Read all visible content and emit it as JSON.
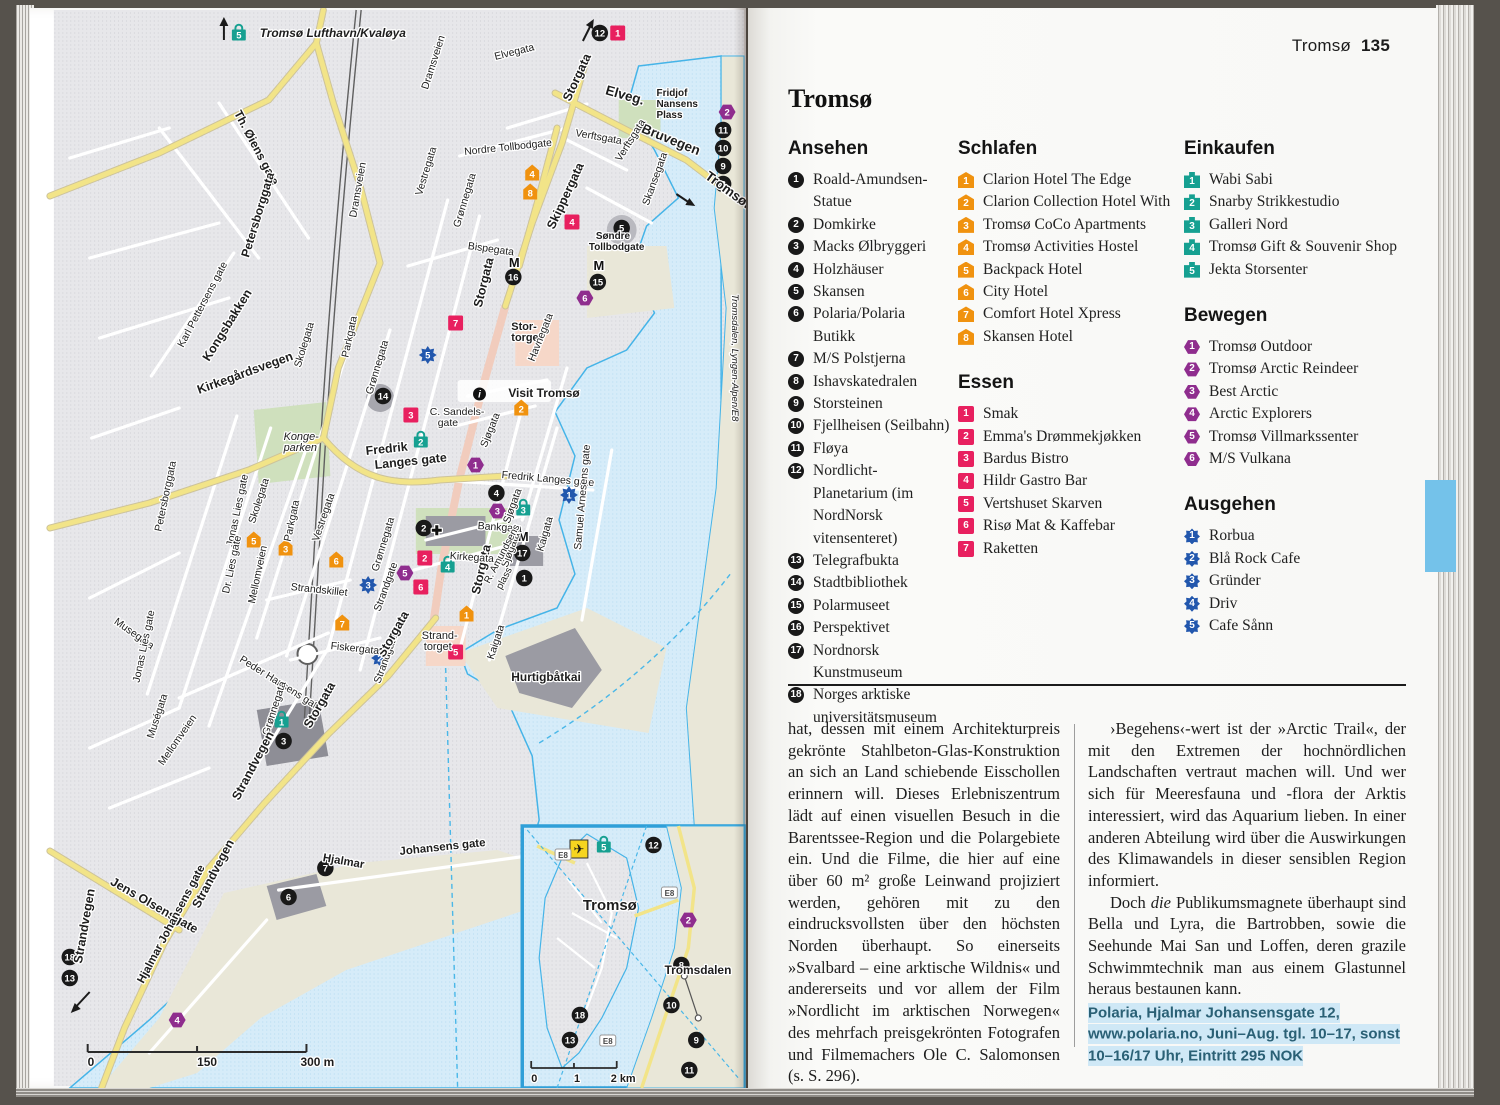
{
  "header": {
    "title": "Tromsø",
    "page_number": "135"
  },
  "title": "Tromsø",
  "section_order": [
    "ansehen",
    "schlafen",
    "essen",
    "einkaufen",
    "bewegen",
    "ausgehen"
  ],
  "sections": {
    "ansehen": {
      "header": "Ansehen",
      "type": "sight",
      "items": [
        "Roald-Amundsen-Statue",
        "Domkirke",
        "Macks Ølbryggeri",
        "Holzhäuser",
        "Skansen",
        "Polaria/Polaria Butikk",
        "M/S Polstjerna",
        "Ishavskatedralen",
        "Storsteinen",
        "Fjellheisen (Seilbahn)",
        "Fløya",
        "Nordlicht-Planetarium (im NordNorsk vitensenteret)",
        "Telegrafbukta",
        "Stadtbibliothek",
        "Polarmuseet",
        "Perspektivet",
        "Nordnorsk Kunstmuseum",
        "Norges arktiske universitätsmuseum"
      ]
    },
    "schlafen": {
      "header": "Schlafen",
      "type": "hotel",
      "items": [
        "Clarion Hotel The Edge",
        "Clarion Collection Hotel With",
        "Tromsø CoCo Apartments",
        "Tromsø Activities Hostel",
        "Backpack Hotel",
        "City Hotel",
        "Comfort Hotel Xpress",
        "Skansen Hotel"
      ]
    },
    "essen": {
      "header": "Essen",
      "type": "food",
      "items": [
        "Smak",
        "Emma's Drømmekjøkken",
        "Bardus Bistro",
        "Hildr Gastro Bar",
        "Vertshuset Skarven",
        "Risø Mat & Kaffebar",
        "Raketten"
      ]
    },
    "einkaufen": {
      "header": "Einkaufen",
      "type": "shop",
      "items": [
        "Wabi Sabi",
        "Snarby Strikkestudio",
        "Galleri Nord",
        "Tromsø Gift & Souvenir Shop",
        "Jekta Storsenter"
      ]
    },
    "bewegen": {
      "header": "Bewegen",
      "type": "move",
      "items": [
        "Tromsø Outdoor",
        "Tromsø Arctic Reindeer",
        "Best Arctic",
        "Arctic Explorers",
        "Tromsø Villmarkssenter",
        "M/S Vulkana"
      ]
    },
    "ausgehen": {
      "header": "Ausgehen",
      "type": "out",
      "items": [
        "Rorbua",
        "Blå Rock Cafe",
        "Gründer",
        "Driv",
        "Cafe Sånn"
      ]
    }
  },
  "body": {
    "col1": "hat, dessen mit einem Architekturpreis gekrönte Stahlbeton-Glas-Konstruktion an sich an Land schiebende Eisschollen erinnern will. Dieses Erlebniszentrum lädt auf einen visuellen Besuch in die Barentssee-Region und die Polargebiete ein. Und die Filme, die hier auf eine über 60 m² große Leinwand projiziert werden, gehören mit zu den eindrucksvollsten über den höchsten Norden überhaupt. So einerseits »Svalbard – eine arktische Wildnis« und andererseits und vor allem der Film »Nordlicht im arktischen Norwegen« des mehrfach preisgekrönten Fotografen und Filmemachers Ole C. Salomonsen (s. S. 296).",
    "col2a": "›Begehens‹-wert ist der »Arctic Trail«, der mit den Extremen der hochnördlichen Landschaften vertraut machen will. Und wer sich für Meeresfauna und -flora der Arktis interessiert, wird das Aquarium lieben. In einer anderen Abteilung wird über die Auswirkungen des Klimawandels in dieser sensiblen Region informiert.",
    "col2b_pre": "Doch ",
    "col2b_em": "die",
    "col2b_post": " Publikumsmagnete überhaupt sind Bella und Lyra, die Bartrobben, sowie die Seehunde Mai San und Loffen, deren grazile Schwimmtechnik man aus einem Glastunnel heraus bestaunen kann.",
    "info": "Polaria, Hjalmar Johansensgate 12, www.polaria.no, Juni–Aug. tgl. 10–17, sonst 10–16/17 Uhr, Eintritt 295 NOK"
  },
  "colors": {
    "sight": "#191919",
    "hotel": "#f0920f",
    "food": "#e8205f",
    "shop": "#16a091",
    "move": "#8f2d8e",
    "out": "#2257ad",
    "water": "#d6ecf9",
    "road": "#f2e488",
    "tab": "#74c2ea"
  },
  "map": {
    "labels": [
      {
        "t": "Tromsø Lufthavn/Kvaløya",
        "x": 231,
        "y": 29,
        "s": 12,
        "b": 1,
        "it": 1
      },
      {
        "t": "Elvegata",
        "x": 468,
        "y": 52,
        "r": -14
      },
      {
        "t": "Storgata",
        "x": 543,
        "y": 94,
        "r": -65,
        "b": 1,
        "s": 12.5
      },
      {
        "t": "Elveg.",
        "x": 578,
        "y": 86,
        "r": 16,
        "b": 1,
        "s": 13.5
      },
      {
        "t": "Dramsveien",
        "x": 400,
        "y": 82,
        "r": -72
      },
      {
        "t": "Fridjof",
        "x": 630,
        "y": 88,
        "s": 10,
        "b": 1
      },
      {
        "t": "Nansens",
        "x": 630,
        "y": 99,
        "s": 10,
        "b": 1
      },
      {
        "t": "Plass",
        "x": 630,
        "y": 110,
        "s": 10,
        "b": 1
      },
      {
        "t": "Bruvegen",
        "x": 614,
        "y": 124,
        "r": 22,
        "b": 1,
        "s": 13.5
      },
      {
        "t": "Tromsøbru",
        "x": 678,
        "y": 170,
        "r": 36,
        "b": 1,
        "s": 13.5
      },
      {
        "t": "Th. Øiens gate",
        "x": 205,
        "y": 105,
        "r": 62,
        "s": 12,
        "b": 1
      },
      {
        "t": "Nordre Tollbodgate",
        "x": 437,
        "y": 147,
        "r": -6
      },
      {
        "t": "Verftsgata",
        "x": 548,
        "y": 128,
        "r": 10
      },
      {
        "t": "Verftsgata",
        "x": 594,
        "y": 154,
        "r": -58
      },
      {
        "t": "Skansegata",
        "x": 622,
        "y": 198,
        "r": -70
      },
      {
        "t": "Skippergata",
        "x": 527,
        "y": 222,
        "r": -65,
        "b": 1,
        "s": 12.5
      },
      {
        "t": "Søndre",
        "x": 569,
        "y": 231,
        "s": 10,
        "b": 1
      },
      {
        "t": "Tollbodgate",
        "x": 562,
        "y": 242,
        "s": 10,
        "b": 1
      },
      {
        "t": "Dramsveien",
        "x": 328,
        "y": 210,
        "r": -80
      },
      {
        "t": "Vestregata",
        "x": 394,
        "y": 188,
        "r": -73
      },
      {
        "t": "Grønnegata",
        "x": 432,
        "y": 220,
        "r": -73
      },
      {
        "t": "Bispegata",
        "x": 440,
        "y": 241,
        "r": 8
      },
      {
        "t": "Petersborggata",
        "x": 220,
        "y": 250,
        "r": -73,
        "b": 1,
        "s": 12
      },
      {
        "t": "Kirkegårdsvegen",
        "x": 170,
        "y": 386,
        "r": -20,
        "b": 1,
        "s": 12.5
      },
      {
        "t": "Karl Pettersens gate",
        "x": 154,
        "y": 340,
        "r": -62
      },
      {
        "t": "Skolegata",
        "x": 272,
        "y": 360,
        "r": -73
      },
      {
        "t": "Parkgata",
        "x": 320,
        "y": 350,
        "r": -78
      },
      {
        "t": "Storgata",
        "x": 454,
        "y": 300,
        "r": -76,
        "b": 1,
        "s": 12.5
      },
      {
        "t": "Stor-",
        "x": 484,
        "y": 322,
        "s": 11,
        "b": 1
      },
      {
        "t": "torget",
        "x": 484,
        "y": 333,
        "s": 11,
        "b": 1
      },
      {
        "t": "Havnegata",
        "x": 507,
        "y": 354,
        "r": -68
      },
      {
        "t": "Visit Tromsø",
        "x": 481,
        "y": 389,
        "s": 12,
        "b": 1
      },
      {
        "t": "C. Sandels-",
        "x": 402,
        "y": 407,
        "s": 10.5
      },
      {
        "t": "gate",
        "x": 410,
        "y": 418,
        "s": 10.5
      },
      {
        "t": "Kongsbakken",
        "x": 180,
        "y": 354,
        "r": -58,
        "b": 1,
        "s": 12.5
      },
      {
        "t": "Konge-",
        "x": 255,
        "y": 432,
        "s": 11,
        "it": 1
      },
      {
        "t": "parken",
        "x": 255,
        "y": 443,
        "s": 11,
        "it": 1
      },
      {
        "t": "Fredrik",
        "x": 338,
        "y": 447,
        "s": 12.5,
        "b": 1,
        "r": -6
      },
      {
        "t": "Langes gate",
        "x": 347,
        "y": 461,
        "s": 12.5,
        "b": 1,
        "r": -6
      },
      {
        "t": "Sjøgata",
        "x": 459,
        "y": 440,
        "r": -68
      },
      {
        "t": "Fredrik Langes gate",
        "x": 474,
        "y": 470,
        "r": 5,
        "s": 10.5
      },
      {
        "t": "Grønnegata",
        "x": 344,
        "y": 387,
        "r": -73
      },
      {
        "t": "Vestregata",
        "x": 290,
        "y": 534,
        "r": -71
      },
      {
        "t": "Grønnegata",
        "x": 350,
        "y": 564,
        "r": -73
      },
      {
        "t": "Storgata",
        "x": 452,
        "y": 587,
        "r": -77,
        "b": 1,
        "s": 12.5
      },
      {
        "t": "Bankgata",
        "x": 450,
        "y": 521,
        "r": 4
      },
      {
        "t": "Kirkegata",
        "x": 422,
        "y": 551,
        "r": 4
      },
      {
        "t": "Sjøgata",
        "x": 482,
        "y": 516,
        "r": -70
      },
      {
        "t": "Sjøgata",
        "x": 480,
        "y": 560,
        "r": -70
      },
      {
        "t": "Kaigata",
        "x": 516,
        "y": 544,
        "r": -74
      },
      {
        "t": "R. Amundsens",
        "x": 462,
        "y": 576,
        "r": -62,
        "s": 10
      },
      {
        "t": "plass",
        "x": 474,
        "y": 582,
        "r": -62,
        "s": 10
      },
      {
        "t": "Samuel Arnesens gate",
        "x": 554,
        "y": 542,
        "r": -85
      },
      {
        "t": "Parkgata",
        "x": 262,
        "y": 534,
        "r": -78
      },
      {
        "t": "Skolegata",
        "x": 226,
        "y": 516,
        "r": -72
      },
      {
        "t": "Petersborggata",
        "x": 132,
        "y": 524,
        "r": -78
      },
      {
        "t": "Jonas Lies gate",
        "x": 204,
        "y": 539,
        "r": -78
      },
      {
        "t": "Dr. Lies gate",
        "x": 200,
        "y": 586,
        "r": -78
      },
      {
        "t": "Mellomveien",
        "x": 226,
        "y": 596,
        "r": -78
      },
      {
        "t": "Strandskillet",
        "x": 262,
        "y": 582,
        "r": 6
      },
      {
        "t": "Strandgate",
        "x": 352,
        "y": 604,
        "r": -70
      },
      {
        "t": "Strandgate",
        "x": 352,
        "y": 676,
        "r": -70
      },
      {
        "t": "Storgata",
        "x": 356,
        "y": 650,
        "r": -60,
        "b": 1,
        "s": 12.5
      },
      {
        "t": "Strand-",
        "x": 394,
        "y": 631,
        "s": 11
      },
      {
        "t": "torget",
        "x": 396,
        "y": 642,
        "s": 11
      },
      {
        "t": "Kaigata",
        "x": 466,
        "y": 652,
        "r": -72
      },
      {
        "t": "Fiskergata",
        "x": 302,
        "y": 641,
        "r": 6
      },
      {
        "t": "Hurtigbåtkai",
        "x": 484,
        "y": 673,
        "s": 12,
        "b": 1
      },
      {
        "t": "Peder Hansens gate",
        "x": 210,
        "y": 653,
        "r": 32
      },
      {
        "t": "Musegata",
        "x": 84,
        "y": 615,
        "r": 35
      },
      {
        "t": "Jonas Lies gate",
        "x": 110,
        "y": 675,
        "r": -78
      },
      {
        "t": "Muségata",
        "x": 124,
        "y": 731,
        "r": -72
      },
      {
        "t": "Mellomveien",
        "x": 134,
        "y": 758,
        "r": -55
      },
      {
        "t": "Grønnegata",
        "x": 240,
        "y": 728,
        "r": -72
      },
      {
        "t": "Storgata",
        "x": 282,
        "y": 721,
        "r": -60,
        "b": 1,
        "s": 12.5
      },
      {
        "t": "Strandvegen",
        "x": 210,
        "y": 793,
        "r": -62,
        "b": 1,
        "s": 12.5
      },
      {
        "t": "Hjalmar",
        "x": 294,
        "y": 853,
        "r": 10,
        "s": 11.5,
        "b": 1
      },
      {
        "t": "Johansens gate",
        "x": 372,
        "y": 847,
        "r": -6,
        "s": 11.5,
        "b": 1
      },
      {
        "t": "Jens Olsensgate",
        "x": 80,
        "y": 876,
        "r": 30,
        "b": 1,
        "s": 12.5
      },
      {
        "t": "Strandvegen",
        "x": 170,
        "y": 901,
        "r": -62,
        "b": 1,
        "s": 12.5
      },
      {
        "t": "Hjalmar Johansens gate",
        "x": 114,
        "y": 976,
        "r": -62,
        "s": 11.5,
        "b": 1
      },
      {
        "t": "Strandvegen",
        "x": 52,
        "y": 956,
        "r": -80,
        "b": 1,
        "s": 12.5
      },
      {
        "t": "Tromsdalen, Lyngen-Alpen/E8",
        "x": 706,
        "y": 286,
        "r": 90,
        "s": 9.5,
        "it": 1
      },
      {
        "t": "0",
        "x": 58,
        "y": 1058,
        "s": 12,
        "b": 1
      },
      {
        "t": "150",
        "x": 168,
        "y": 1058,
        "s": 12,
        "b": 1
      },
      {
        "t": "300 m",
        "x": 272,
        "y": 1058,
        "s": 12,
        "b": 1
      },
      {
        "t": "Tromsø",
        "x": 556,
        "y": 902,
        "s": 15,
        "b": 1
      },
      {
        "t": "Tromsdalen",
        "x": 638,
        "y": 966,
        "s": 12,
        "b": 1
      },
      {
        "t": "0",
        "x": 504,
        "y": 1074,
        "s": 11,
        "b": 1
      },
      {
        "t": "1",
        "x": 547,
        "y": 1074,
        "s": 11,
        "b": 1
      },
      {
        "t": "2 km",
        "x": 584,
        "y": 1074,
        "s": 11,
        "b": 1
      }
    ],
    "markers": [
      {
        "k": "sight",
        "n": "1",
        "x": 497,
        "y": 570
      },
      {
        "k": "sight",
        "n": "2",
        "x": 396,
        "y": 520
      },
      {
        "k": "sight",
        "n": "3",
        "x": 255,
        "y": 733
      },
      {
        "k": "sight",
        "n": "4",
        "x": 469,
        "y": 485
      },
      {
        "k": "sight",
        "n": "5",
        "x": 595,
        "y": 220
      },
      {
        "k": "sight",
        "n": "6",
        "x": 260,
        "y": 889
      },
      {
        "k": "sight",
        "n": "7",
        "x": 297,
        "y": 860
      },
      {
        "k": "sight",
        "n": "8",
        "x": 697,
        "y": 176
      },
      {
        "k": "sight",
        "n": "9",
        "x": 697,
        "y": 158
      },
      {
        "k": "sight",
        "n": "10",
        "x": 697,
        "y": 140
      },
      {
        "k": "sight",
        "n": "11",
        "x": 697,
        "y": 122
      },
      {
        "k": "sight",
        "n": "12",
        "x": 573,
        "y": 25
      },
      {
        "k": "sight",
        "n": "13",
        "x": 40,
        "y": 970
      },
      {
        "k": "sight",
        "n": "14",
        "x": 355,
        "y": 388
      },
      {
        "k": "sight",
        "n": "15",
        "x": 571,
        "y": 274
      },
      {
        "k": "sight",
        "n": "16",
        "x": 486,
        "y": 269
      },
      {
        "k": "sight",
        "n": "17",
        "x": 495,
        "y": 545
      },
      {
        "k": "sight",
        "n": "18",
        "x": 40,
        "y": 949
      },
      {
        "k": "hotel",
        "n": "1",
        "x": 439,
        "y": 606
      },
      {
        "k": "hotel",
        "n": "2",
        "x": 494,
        "y": 400
      },
      {
        "k": "hotel",
        "n": "3",
        "x": 257,
        "y": 540
      },
      {
        "k": "hotel",
        "n": "4",
        "x": 505,
        "y": 165
      },
      {
        "k": "hotel",
        "n": "5",
        "x": 225,
        "y": 532
      },
      {
        "k": "hotel",
        "n": "6",
        "x": 308,
        "y": 552
      },
      {
        "k": "hotel",
        "n": "7",
        "x": 314,
        "y": 615
      },
      {
        "k": "hotel",
        "n": "8",
        "x": 503,
        "y": 184
      },
      {
        "k": "food",
        "n": "1",
        "x": 591,
        "y": 25
      },
      {
        "k": "food",
        "n": "2",
        "x": 397,
        "y": 550
      },
      {
        "k": "food",
        "n": "3",
        "x": 383,
        "y": 407
      },
      {
        "k": "food",
        "n": "4",
        "x": 545,
        "y": 214
      },
      {
        "k": "food",
        "n": "5",
        "x": 428,
        "y": 644
      },
      {
        "k": "food",
        "n": "6",
        "x": 393,
        "y": 579
      },
      {
        "k": "food",
        "n": "7",
        "x": 428,
        "y": 315
      },
      {
        "k": "shop",
        "n": "1",
        "x": 253,
        "y": 712
      },
      {
        "k": "shop",
        "n": "2",
        "x": 393,
        "y": 432
      },
      {
        "k": "shop",
        "n": "3",
        "x": 496,
        "y": 500
      },
      {
        "k": "shop",
        "n": "4",
        "x": 420,
        "y": 557
      },
      {
        "k": "shop",
        "n": "5",
        "x": 210,
        "y": 25
      },
      {
        "k": "move",
        "n": "1",
        "x": 448,
        "y": 457
      },
      {
        "k": "move",
        "n": "2",
        "x": 701,
        "y": 104
      },
      {
        "k": "move",
        "n": "3",
        "x": 470,
        "y": 503
      },
      {
        "k": "move",
        "n": "4",
        "x": 148,
        "y": 1012
      },
      {
        "k": "move",
        "n": "5",
        "x": 377,
        "y": 565
      },
      {
        "k": "move",
        "n": "6",
        "x": 558,
        "y": 290
      },
      {
        "k": "out",
        "n": "1",
        "x": 542,
        "y": 487
      },
      {
        "k": "out",
        "n": "2",
        "x": 352,
        "y": 650
      },
      {
        "k": "out",
        "n": "3",
        "x": 340,
        "y": 577
      },
      {
        "k": "out",
        "n": "5",
        "x": 400,
        "y": 347
      },
      {
        "k": "sight",
        "n": "12",
        "x": 627,
        "y": 837
      },
      {
        "k": "move",
        "n": "2",
        "x": 662,
        "y": 912
      },
      {
        "k": "sight",
        "n": "8",
        "x": 655,
        "y": 957
      },
      {
        "k": "sight",
        "n": "10",
        "x": 645,
        "y": 997
      },
      {
        "k": "sight",
        "n": "9",
        "x": 670,
        "y": 1032
      },
      {
        "k": "sight",
        "n": "11",
        "x": 663,
        "y": 1062
      },
      {
        "k": "sight",
        "n": "18",
        "x": 553,
        "y": 1007
      },
      {
        "k": "sight",
        "n": "13",
        "x": 543,
        "y": 1032
      },
      {
        "k": "shop",
        "n": "5",
        "x": 577,
        "y": 837
      }
    ],
    "icons": [
      {
        "g": "M",
        "x": 487,
        "y": 259
      },
      {
        "g": "M",
        "x": 572,
        "y": 262
      },
      {
        "g": "M",
        "x": 496,
        "y": 533
      },
      {
        "g": "i",
        "x": 452,
        "y": 386,
        "circ": 1
      },
      {
        "g": "✚",
        "x": 409,
        "y": 527,
        "plain": 1
      },
      {
        "g": "✈",
        "x": 552,
        "y": 841,
        "plane": 1
      },
      {
        "g": "E8",
        "x": 536,
        "y": 847,
        "shield": 1
      },
      {
        "g": "E8",
        "x": 643,
        "y": 885,
        "shield": 1
      },
      {
        "g": "E8",
        "x": 581,
        "y": 1033,
        "shield": 1
      }
    ]
  }
}
